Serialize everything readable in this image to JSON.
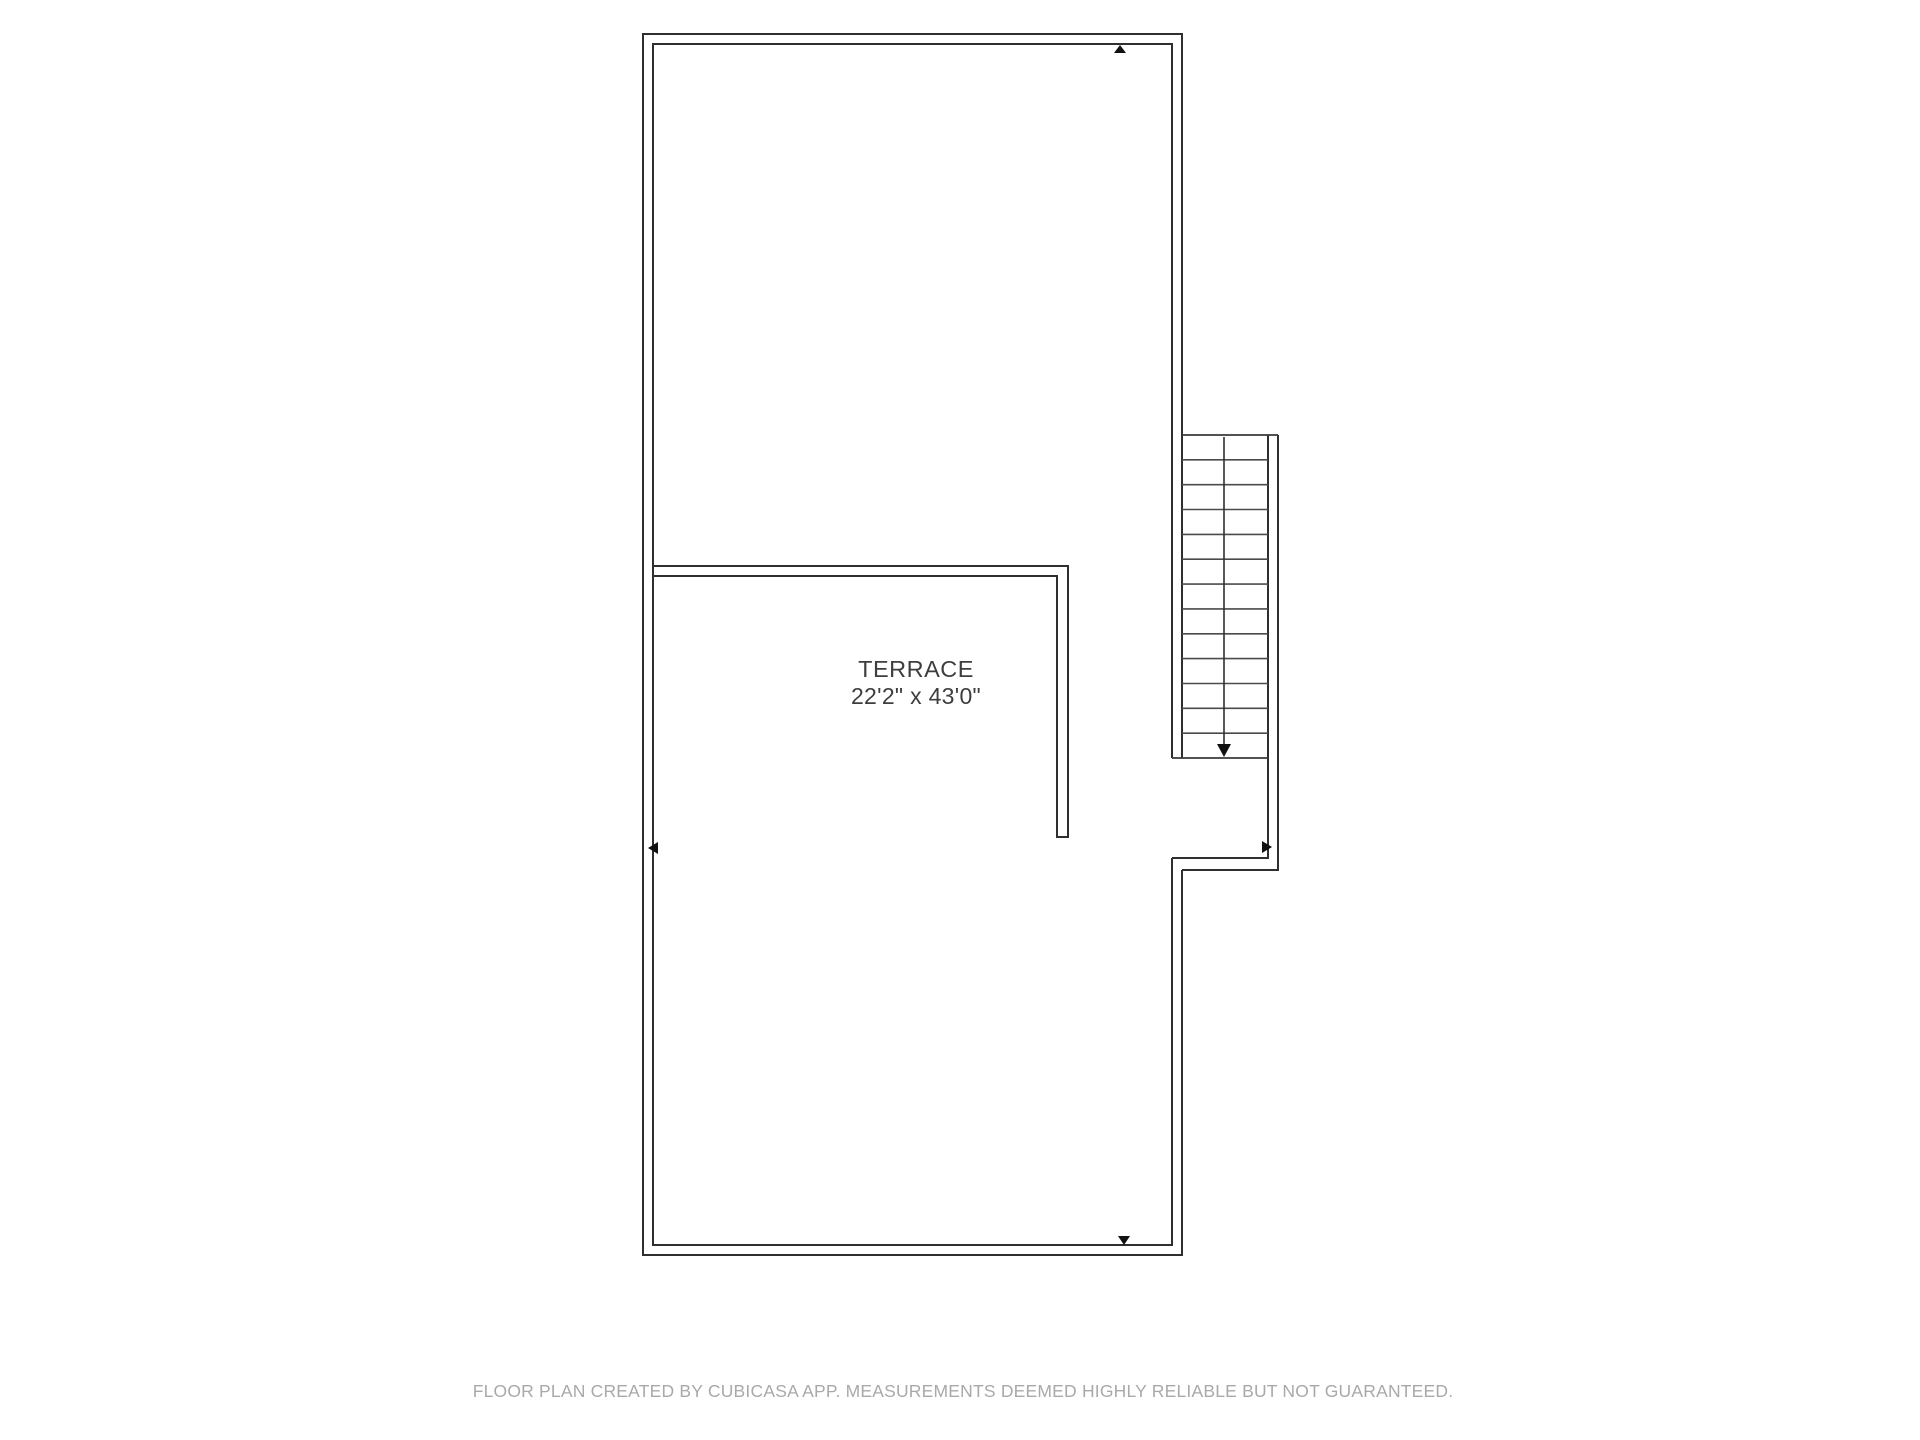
{
  "page": {
    "background_color": "#ffffff",
    "wall_color": "#2f2f2f",
    "marker_color": "#111111",
    "footer_text_color": "#a9a9a9"
  },
  "floor_plan": {
    "room": {
      "name": "TERRACE",
      "dimensions": "22'2\" x 43'0\""
    },
    "stairs": {
      "steps": 13,
      "direction": "down",
      "top_y": 435,
      "bottom_y": 758,
      "left_x": 1182,
      "right_x": 1268
    },
    "markers": [
      {
        "icon": "arrow-up-marker",
        "position": "top-wall"
      },
      {
        "icon": "arrow-left-marker",
        "position": "left-wall"
      },
      {
        "icon": "arrow-right-marker",
        "position": "stair-right-wall"
      },
      {
        "icon": "arrow-down-marker",
        "position": "bottom-wall"
      },
      {
        "icon": "stair-down-arrow",
        "position": "stair-walkline"
      }
    ]
  },
  "footer": {
    "disclaimer": "FLOOR PLAN CREATED BY CUBICASA APP. MEASUREMENTS DEEMED HIGHLY RELIABLE BUT NOT GUARANTEED."
  }
}
